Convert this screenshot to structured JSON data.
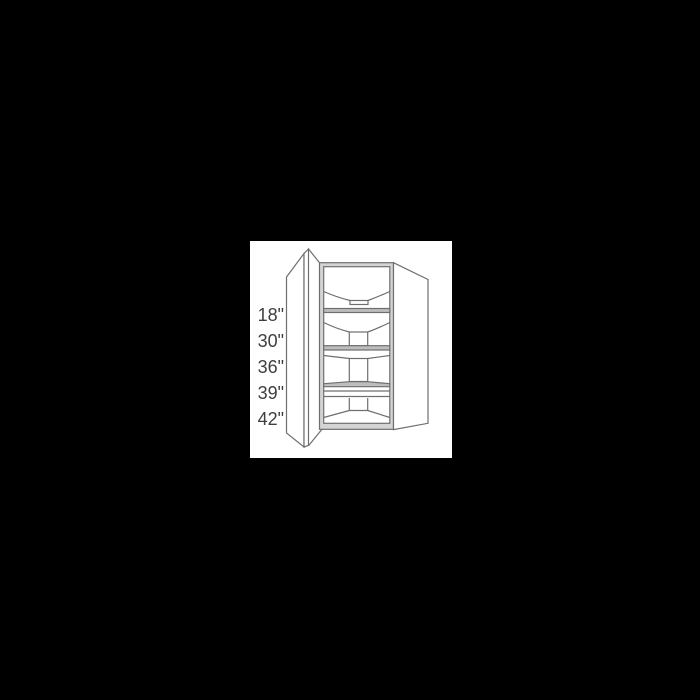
{
  "canvas": {
    "background_color": "#000000"
  },
  "product_image": {
    "background_color": "#ffffff",
    "line_color": "#6f6f6f",
    "shelf_band_color": "#bdbdbd",
    "frame_fill_color": "#d4d4d4",
    "label_color": "#3f3f3f",
    "description": "Line drawing of a diagonal corner wall cabinet with open door and lazy susan shelves",
    "dimension_labels": [
      "18\"",
      "30\"",
      "36\"",
      "39\"",
      "42\""
    ]
  }
}
